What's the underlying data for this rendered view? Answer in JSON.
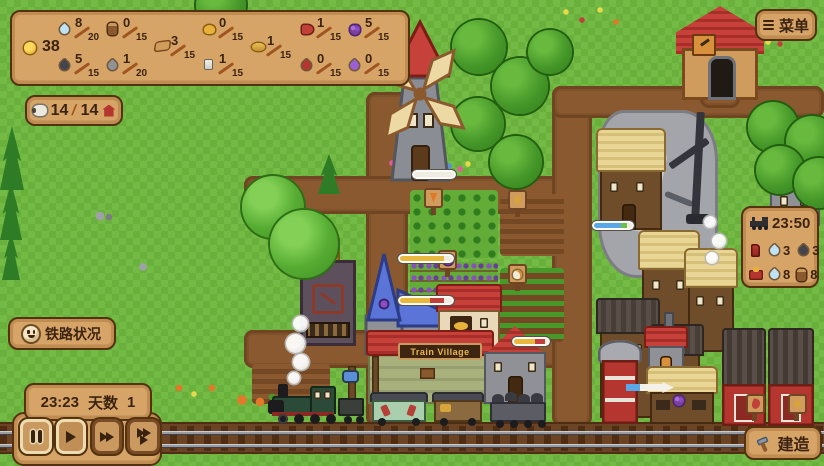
{
  "colors": {
    "panel_bg": "#d7a468",
    "panel_border": "#53320f",
    "panel_text": "#3c2310",
    "grass": "#69b13c",
    "road": "#8a5930",
    "roof_red": "#c6413a",
    "thatch": "#e9d694",
    "progress_yellow": "#e9b93d",
    "progress_red": "#c2403a",
    "progress_blue": "#5aa7e8"
  },
  "icons": {
    "menu": "hamburger-icon",
    "build": "hammer-icon",
    "railway_status": "smiley-icon",
    "population_left": "sheep-icon",
    "population_right": "house-icon",
    "speed": [
      "pause-icon",
      "play-icon",
      "fast-forward-icon",
      "fastest-icon"
    ]
  },
  "resources": {
    "coin": "38",
    "items": [
      {
        "name": "water",
        "num": "8",
        "den": "20"
      },
      {
        "name": "coal",
        "num": "5",
        "den": "15"
      },
      {
        "name": "log",
        "num": "0",
        "den": "15"
      },
      {
        "name": "stone",
        "num": "1",
        "den": "20"
      },
      {
        "name": "plank",
        "num": "3",
        "den": "15"
      },
      {
        "name": "cheese",
        "num": "0",
        "den": "15"
      },
      {
        "name": "spool",
        "num": "1",
        "den": "15"
      },
      {
        "name": "bread",
        "num": "1",
        "den": "15"
      },
      {
        "name": "meat",
        "num": "1",
        "den": "15"
      },
      {
        "name": "wine",
        "num": "0",
        "den": "15"
      },
      {
        "name": "grapes",
        "num": "5",
        "den": "15"
      },
      {
        "name": "mana",
        "num": "0",
        "den": "15"
      }
    ]
  },
  "population": {
    "current": "14",
    "sep": "/",
    "capacity": "14"
  },
  "menu": {
    "label": "菜单"
  },
  "train_status": {
    "next_time": "23:50",
    "boiler": {
      "water": "3",
      "coal": "3"
    },
    "tender": {
      "water": "8",
      "logs": "8"
    }
  },
  "railway_button": {
    "label": "铁路状况"
  },
  "time_panel": {
    "clock": "23:23",
    "day_label": "天数",
    "day_value": "1"
  },
  "build": {
    "label": "建造"
  },
  "scene": {
    "station_sign": "Train Village"
  }
}
